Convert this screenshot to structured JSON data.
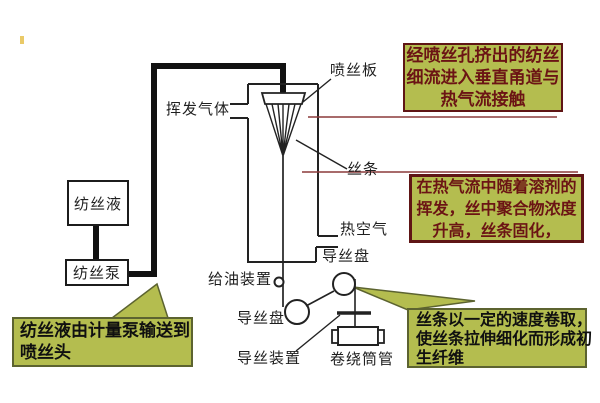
{
  "diagram": {
    "labels": {
      "spinneret_plate": "喷丝板",
      "volatile_gas": "挥发气体",
      "filament": "丝条",
      "hot_air": "热空气",
      "godet_top": "导丝盘",
      "oiling_device": "给油装置",
      "godet_bottom": "导丝盘",
      "guide_device": "导丝装置",
      "winding_bobbin": "卷绕筒管",
      "spinning_solution": "纺丝液",
      "spinning_pump": "纺丝泵"
    },
    "callouts": {
      "top_right": {
        "lines": [
          "经喷丝孔挤出的纺丝",
          "细流进入垂直甬道与",
          "热气流接触"
        ]
      },
      "middle_right": {
        "lines": [
          "在热气流中随着溶剂的",
          "挥发，丝中聚合物浓度",
          "升高，丝条固化，"
        ]
      },
      "bottom_right": {
        "lines": [
          "丝条以一定的速度卷取，",
          "使丝条拉伸细化而形成初",
          "生纤维"
        ]
      },
      "bottom_left": {
        "lines": [
          "纺丝液由计量泵输送到",
          "喷丝头"
        ]
      }
    },
    "colors": {
      "callout_fill": "#b4bd4f",
      "callout_border_red": "#5f1515",
      "callout_text_red": "#6b1414",
      "callout_border_olive": "#5c6330",
      "connector_red_line": "#8b3a3a",
      "diagram_line": "#1c1c1c"
    }
  }
}
